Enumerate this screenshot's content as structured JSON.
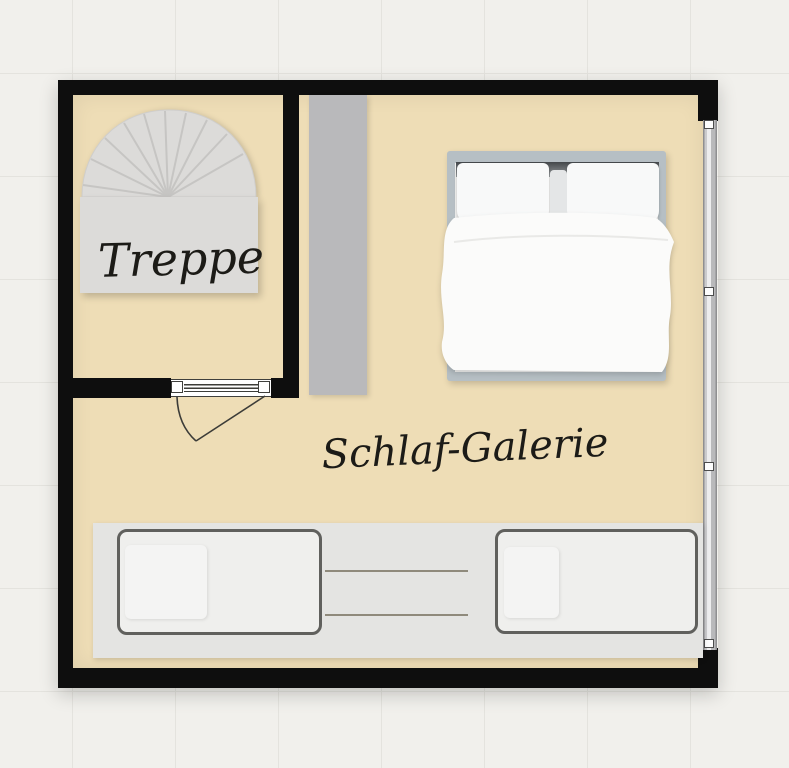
{
  "plan": {
    "stair_label": "Treppe",
    "room_label": "Schlaf-Galerie"
  },
  "theme_colors": {
    "canvas-bg": "#f1f0ec",
    "grid-line": "#e4e3de",
    "floor": "#eeddb6",
    "wall": "#0e0e0e",
    "stair-fill": "#dcdbd9",
    "stair-line": "#c6c5c3",
    "column": "#b9b9bb",
    "bed-frame": "#b6bfc4",
    "platform": "#e4e4e2",
    "single-bed-outline": "#60605d",
    "single-bed-fill": "#efefed",
    "window-frame": "#8f8f91",
    "window-glass": "#b9b9bb",
    "door-line": "#3c3c38",
    "table-line": "#8f8a7c",
    "ink": "#1c1b17"
  }
}
